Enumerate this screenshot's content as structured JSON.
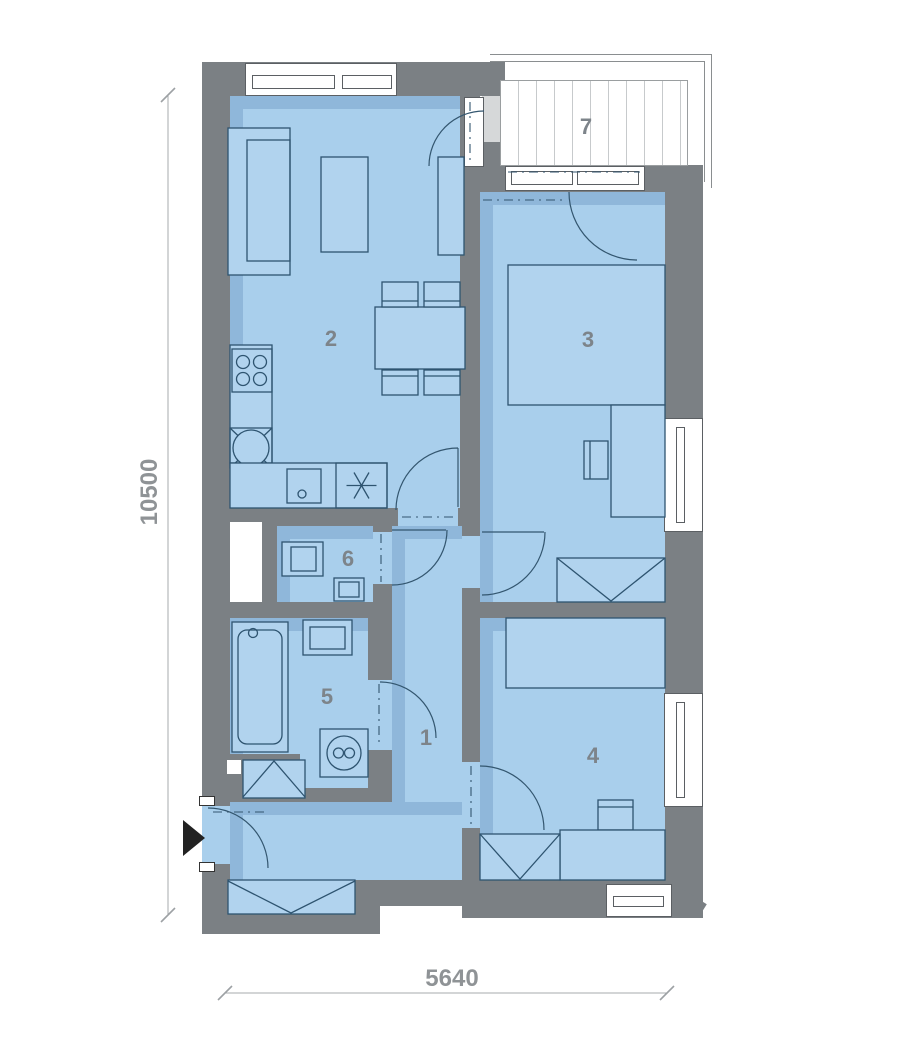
{
  "floor_plan": {
    "room_labels": [
      "1",
      "2",
      "3",
      "4",
      "5",
      "6",
      "7"
    ],
    "dimensions": {
      "vertical": "10500",
      "horizontal": "5640"
    },
    "colors": {
      "wall": "#7b8084",
      "floor": "#a9cfec",
      "floor_shadow": "#8fb7da",
      "furniture_outline": "#2e5470",
      "room_label": "#7d848a",
      "dimension_text": "#8f9396",
      "balcony_deck_stripe": "#c7cacc",
      "background": "#ffffff"
    }
  }
}
